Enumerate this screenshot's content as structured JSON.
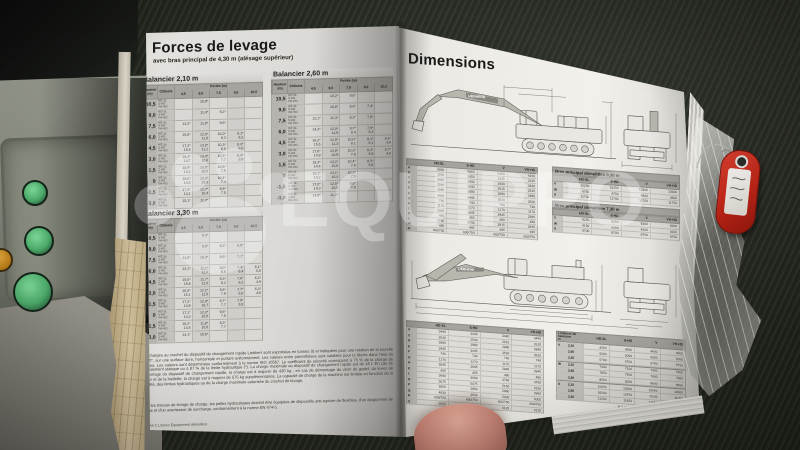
{
  "colors": {
    "key_tag_red": "#c0281c",
    "page_white": "#f2f0ea",
    "seat_dark": "#262924",
    "console_green": "#4aa868",
    "watermark_white": "rgba(255,255,255,0.30)",
    "ink": "#232220",
    "table_header_gray": "#a6a49f"
  },
  "watermark": {
    "text": "EQUIPPO",
    "logo": "paw-logo"
  },
  "left_page": {
    "title": "Forces de levage",
    "subtitle": "avec bras principal de 4,30 m (alésage supérieur)",
    "row_header_1": "Hauteur (m)",
    "row_header_2": "Châssis",
    "portee_label": "Portée (m)",
    "col_headers": [
      "4,5",
      "6,0",
      "7,5",
      "9,0",
      "10,5"
    ],
    "chassis_variants": [
      "HD-SL",
      "S-HD",
      "VH-HD"
    ],
    "tables": [
      {
        "title": "Balancier 2,10 m",
        "rows": [
          {
            "h": "10,5",
            "v": [
              "",
              "10,9*",
              "",
              "",
              ""
            ]
          },
          {
            "h": "9,0",
            "v": [
              "",
              "11,4*",
              "9,2*",
              "",
              ""
            ]
          },
          {
            "h": "7,5",
            "v": [
              "13,2*",
              "11,9*",
              "9,6*",
              "",
              ""
            ]
          },
          {
            "h": "6,0",
            "v": [
              "15,6*",
              "12,5* 11,8",
              "10,0* 8,3",
              "8,1* 6,2",
              ""
            ]
          },
          {
            "h": "4,5",
            "v": [
              "17,3* 15,4",
              "13,0* 11,2",
              "10,3* 8,0",
              "8,3* 6,0",
              ""
            ]
          },
          {
            "h": "3,0",
            "v": [
              "18,4* 14,7",
              "13,4* 10,8",
              "10,5* 7,7",
              "8,4* 5,9",
              ""
            ]
          },
          {
            "h": "1,5",
            "v": [
              "18,9* 14,2",
              "13,5* 10,5",
              "10,6* 7,5",
              "",
              ""
            ]
          },
          {
            "h": "0",
            "v": [
              "18,6* 14,0",
              "13,3* 10,3",
              "10,4* 7,4",
              "",
              ""
            ]
          },
          {
            "h": "-1,5",
            "v": [
              "17,4* 14,1",
              "12,7* 10,4",
              "9,9* 7,5",
              "",
              ""
            ]
          },
          {
            "h": "-3,0",
            "v": [
              "15,1*",
              "11,4*",
              "",
              "",
              ""
            ]
          }
        ]
      },
      {
        "title": "Balancier 2,60 m",
        "rows": [
          {
            "h": "10,5",
            "v": [
              "",
              "10,2*",
              "8,6*",
              "",
              ""
            ]
          },
          {
            "h": "9,0",
            "v": [
              "",
              "10,8*",
              "8,9*",
              "7,4*",
              ""
            ]
          },
          {
            "h": "7,5",
            "v": [
              "12,1*",
              "11,3*",
              "9,3*",
              "7,6*",
              ""
            ]
          },
          {
            "h": "6,0",
            "v": [
              "14,3*",
              "12,0* 11,9",
              "9,7* 8,4",
              "7,9* 6,3",
              ""
            ]
          },
          {
            "h": "4,5",
            "v": [
              "16,2* 15,6",
              "12,6* 11,3",
              "10,0* 8,1",
              "8,1* 6,1",
              "6,6* 4,9"
            ]
          },
          {
            "h": "3,0",
            "v": [
              "17,6* 14,9",
              "13,0* 10,9",
              "10,3* 7,8",
              "8,2* 5,9",
              "6,7* 4,8"
            ]
          },
          {
            "h": "1,5",
            "v": [
              "18,3* 14,4",
              "13,2* 10,6",
              "10,4* 7,6",
              "8,3* 5,8",
              ""
            ]
          },
          {
            "h": "0",
            "v": [
              "18,1* 14,2",
              "13,1* 10,4",
              "10,3* 7,5",
              "",
              ""
            ]
          },
          {
            "h": "-1,5",
            "v": [
              "17,0* 14,3",
              "12,5* 10,5",
              "9,8* 7,6",
              "",
              ""
            ]
          },
          {
            "h": "-3,0",
            "v": [
              "14,8*",
              "11,2*",
              "",
              "",
              ""
            ]
          }
        ]
      },
      {
        "title": "Balancier 3,30 m",
        "rows": [
          {
            "h": "10,5",
            "v": [
              "",
              "9,4*",
              "",
              "",
              ""
            ]
          },
          {
            "h": "9,0",
            "v": [
              "",
              "9,9*",
              "8,2*",
              "6,9*",
              ""
            ]
          },
          {
            "h": "7,5",
            "v": [
              "11,0*",
              "10,4*",
              "8,6*",
              "7,1*",
              ""
            ]
          },
          {
            "h": "6,0",
            "v": [
              "13,1*",
              "11,1* 12,0",
              "9,0* 8,6",
              "7,4* 6,4",
              "6,1* 5,0"
            ]
          },
          {
            "h": "4,5",
            "v": [
              "15,0* 15,8",
              "11,7* 11,5",
              "9,3* 8,2",
              "7,6* 6,2",
              "6,2* 4,9"
            ]
          },
          {
            "h": "3,0",
            "v": [
              "16,4* 15,1",
              "12,2* 11,0",
              "9,6* 7,9",
              "7,7* 6,0",
              "6,3* 4,8"
            ]
          },
          {
            "h": "1,5",
            "v": [
              "17,2* 14,6",
              "12,4* 10,7",
              "9,7* 7,7",
              "7,8* 5,9",
              ""
            ]
          },
          {
            "h": "0",
            "v": [
              "17,1* 14,3",
              "12,3* 10,5",
              "9,6* 7,6",
              "",
              ""
            ]
          },
          {
            "h": "-1,5",
            "v": [
              "16,2* 14,4",
              "11,8* 10,6",
              "9,2* 7,7",
              "",
              ""
            ]
          },
          {
            "h": "-3,0",
            "v": [
              "14,1*",
              "10,6*",
              "",
              "",
              ""
            ]
          }
        ]
      }
    ],
    "footnote_1": "Les charges au crochet du dispositif de changement rapide Liebherr sont exprimées en tonnes (t) et indiquées pour une rotation de la tourelle à 360°, sur une surface dure, horizontale et portant uniformément. Les valeurs entre parenthèses sont valables pour la flèche dans l'axe du châssis. Les valeurs sont déterminées conformément à la norme ISO 10567. Le coefficient de sécurité correspond à 75 % de la charge de basculement statique ou à 87 % de la limite hydraulique (*). La charge maximale au dispositif de changement rapide est de 18 t. En cas de démontage du dispositif de changement rapide, la charge est à majorer de 430 kg ; en cas de démontage du vérin de godet, du levier de renvoi et de la biellette, la charge est à majorer de 575 kg supplémentaires. La capacité de charge de la machine est limitée en fonction de la stabilité, des limites hydrauliques ou de la charge maximale autorisée du crochet de levage.",
    "footnote_2": "Pour les travaux de levage de charge, les pelles hydrauliques doivent être équipées de dispositifs anti-rupture de flexibles, d'un diagramme de levage et d'un avertisseur de surcharge, conformément à la norme EN 474-5.",
    "footer": "4   R 944 C Litronic Équipement démolition"
  },
  "right_page": {
    "title": "Dimensions",
    "brand": "LIEBHERR",
    "dim_table_headers": [
      "HD-SL",
      "S-HD",
      "V",
      "VH-HD"
    ],
    "upper_left_table": [
      [
        "A",
        "5960",
        "5960",
        "6160",
        "6160"
      ],
      [
        "B",
        "3050",
        "3050",
        "3125",
        "3125"
      ],
      [
        "C",
        "3440",
        "3440",
        "3440",
        "3440"
      ],
      [
        "D",
        "2540",
        "2540",
        "2615",
        "2615"
      ],
      [
        "E",
        "2980",
        "2980",
        "2980",
        "2980"
      ],
      [
        "F",
        "3445",
        "3445",
        "3520",
        "3520"
      ],
      [
        "G",
        "740",
        "740",
        "740",
        "740"
      ],
      [
        "H",
        "1170",
        "1170",
        "1170",
        "1170"
      ],
      [
        "I",
        "2945",
        "2945",
        "2945",
        "2945"
      ],
      [
        "K",
        "455",
        "455",
        "480",
        "480"
      ],
      [
        "L",
        "2740",
        "2740",
        "2815",
        "2815"
      ],
      [
        "M",
        "495",
        "495",
        "495",
        "495"
      ],
      [
        "N",
        "600/750",
        "600/750",
        "600/750",
        "600/750"
      ]
    ],
    "bras_tables": [
      {
        "title": "Bras principal démolition 9,30 m",
        "rows": [
          [
            "V",
            "10250",
            "10250",
            "10300",
            "10300"
          ],
          [
            "W",
            "4750",
            "4750",
            "4800",
            "4800"
          ],
          [
            "X",
            "11700",
            "11700",
            "11750",
            "11750"
          ]
        ]
      },
      {
        "title": "Bras principal démolition 7,30 m",
        "rows": [
          [
            "V",
            "8250",
            "8250",
            "8300",
            "8300"
          ],
          [
            "W",
            "4150",
            "4150",
            "4200",
            "4200"
          ],
          [
            "X",
            "9700",
            "9700",
            "9750",
            "9750"
          ]
        ]
      }
    ],
    "lower_left_table": [
      [
        "A",
        "3440",
        "3440",
        "3440",
        "3440"
      ],
      [
        "C",
        "2540",
        "2540",
        "2615",
        "2615"
      ],
      [
        "D",
        "2980",
        "2980",
        "2980",
        "2980"
      ],
      [
        "E",
        "3445",
        "3445",
        "3520",
        "3520"
      ],
      [
        "F",
        "740",
        "740",
        "740",
        "740"
      ],
      [
        "G",
        "1170",
        "1170",
        "1170",
        "1170"
      ],
      [
        "H",
        "2945",
        "2945",
        "2945",
        "2945"
      ],
      [
        "K",
        "455",
        "455",
        "480",
        "480"
      ],
      [
        "L",
        "3690",
        "3690",
        "3765",
        "3765"
      ],
      [
        "N",
        "5075",
        "5075",
        "5150",
        "5150"
      ],
      [
        "P",
        "2960",
        "2960",
        "2960",
        "2960"
      ],
      [
        "Q",
        "4930",
        "4930",
        "5005",
        "5005"
      ],
      [
        "R",
        "600/750",
        "600/750",
        "600/750",
        "600/750"
      ],
      [
        "S",
        "6050",
        "6050",
        "6125",
        "6125"
      ]
    ],
    "balancier_table": {
      "title": "Longueur de balancier",
      "unit": "m",
      "groups": [
        {
          "letter": "V",
          "rows": [
            [
              "2,10",
              "4550",
              "4550",
              "4600",
              "4600"
            ],
            [
              "2,60",
              "5000",
              "5000",
              "5050",
              "5050"
            ],
            [
              "3,30",
              "5700",
              "5700",
              "5750",
              "5750"
            ]
          ]
        },
        {
          "letter": "W",
          "rows": [
            [
              "2,10",
              "7400",
              "7100",
              "7450",
              "7400"
            ],
            [
              "2,60",
              "7850",
              "7550",
              "7900",
              "7850"
            ],
            [
              "3,30",
              "8550",
              "8250",
              "8600",
              "8550"
            ]
          ]
        },
        {
          "letter": "X",
          "rows": [
            [
              "2,10",
              "10050",
              "10300",
              "10650",
              "10600"
            ],
            [
              "2,60",
              "10500",
              "10750",
              "11100",
              "11050"
            ],
            [
              "3,30",
              "11200",
              "11450",
              "11800",
              "11750"
            ]
          ]
        }
      ]
    },
    "footer": "R 944 C Litronic Équipement démolition   5"
  }
}
